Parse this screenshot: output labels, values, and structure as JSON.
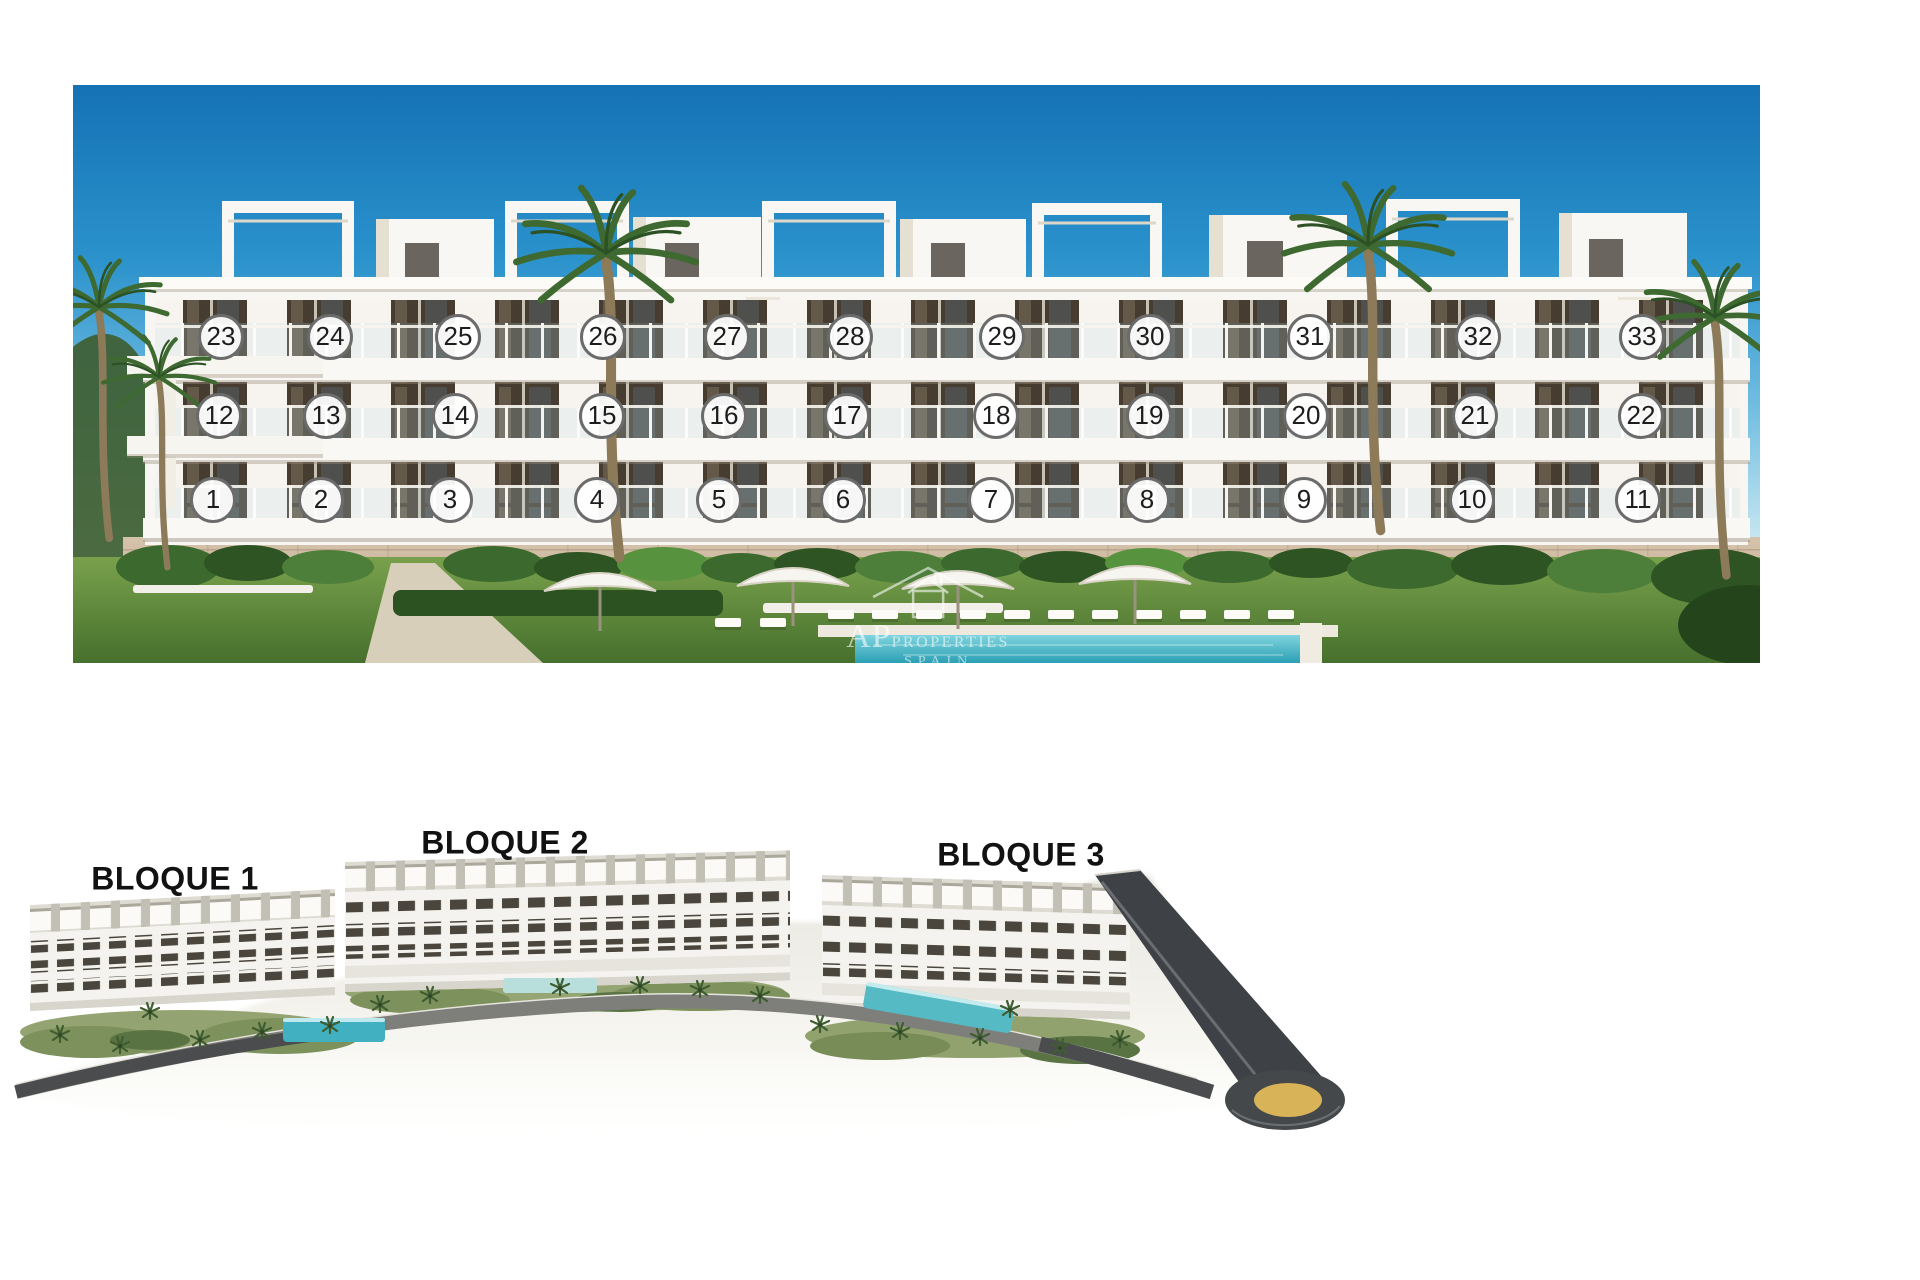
{
  "facade": {
    "description": "front elevation render with numbered apartments",
    "units": [
      {
        "n": 1,
        "x": 213,
        "y": 500
      },
      {
        "n": 2,
        "x": 321,
        "y": 500
      },
      {
        "n": 3,
        "x": 450,
        "y": 500
      },
      {
        "n": 4,
        "x": 597,
        "y": 500
      },
      {
        "n": 5,
        "x": 719,
        "y": 500
      },
      {
        "n": 6,
        "x": 843,
        "y": 500
      },
      {
        "n": 7,
        "x": 991,
        "y": 500
      },
      {
        "n": 8,
        "x": 1147,
        "y": 500
      },
      {
        "n": 9,
        "x": 1304,
        "y": 500
      },
      {
        "n": 10,
        "x": 1472,
        "y": 500
      },
      {
        "n": 11,
        "x": 1638,
        "y": 500
      },
      {
        "n": 12,
        "x": 219,
        "y": 416
      },
      {
        "n": 13,
        "x": 326,
        "y": 416
      },
      {
        "n": 14,
        "x": 455,
        "y": 416
      },
      {
        "n": 15,
        "x": 602,
        "y": 416
      },
      {
        "n": 16,
        "x": 724,
        "y": 416
      },
      {
        "n": 17,
        "x": 847,
        "y": 416
      },
      {
        "n": 18,
        "x": 996,
        "y": 416
      },
      {
        "n": 19,
        "x": 1149,
        "y": 416
      },
      {
        "n": 20,
        "x": 1306,
        "y": 416
      },
      {
        "n": 21,
        "x": 1475,
        "y": 416
      },
      {
        "n": 22,
        "x": 1641,
        "y": 416
      },
      {
        "n": 23,
        "x": 221,
        "y": 337
      },
      {
        "n": 24,
        "x": 330,
        "y": 337
      },
      {
        "n": 25,
        "x": 458,
        "y": 337
      },
      {
        "n": 26,
        "x": 603,
        "y": 337
      },
      {
        "n": 27,
        "x": 727,
        "y": 337
      },
      {
        "n": 28,
        "x": 850,
        "y": 337
      },
      {
        "n": 29,
        "x": 1002,
        "y": 337
      },
      {
        "n": 30,
        "x": 1150,
        "y": 337
      },
      {
        "n": 31,
        "x": 1310,
        "y": 337
      },
      {
        "n": 32,
        "x": 1478,
        "y": 337
      },
      {
        "n": 33,
        "x": 1642,
        "y": 337
      }
    ],
    "watermark": {
      "initials": "AP",
      "word": "PROPERTIES",
      "sub": "SPAIN"
    }
  },
  "masterplan": {
    "description": "aerial render of the three blocks",
    "blocks": [
      {
        "label": "BLOQUE 1",
        "x": 175,
        "y": 879
      },
      {
        "label": "BLOQUE 2",
        "x": 505,
        "y": 843
      },
      {
        "label": "BLOQUE 3",
        "x": 1021,
        "y": 855
      }
    ]
  },
  "colors": {
    "sky_top": "#1472b5",
    "sky_horizon": "#ebf6f8",
    "building_white": "#f8f6f2",
    "window_dark": "#463c30",
    "base_stone": "#c9b49a",
    "grass": "#5d8a3d",
    "pool": "#2aa0b5",
    "road": "#4a4e50",
    "roundabout_center": "#d9b357",
    "circle_border": "#6b6b6b",
    "label_color": "#121212"
  }
}
